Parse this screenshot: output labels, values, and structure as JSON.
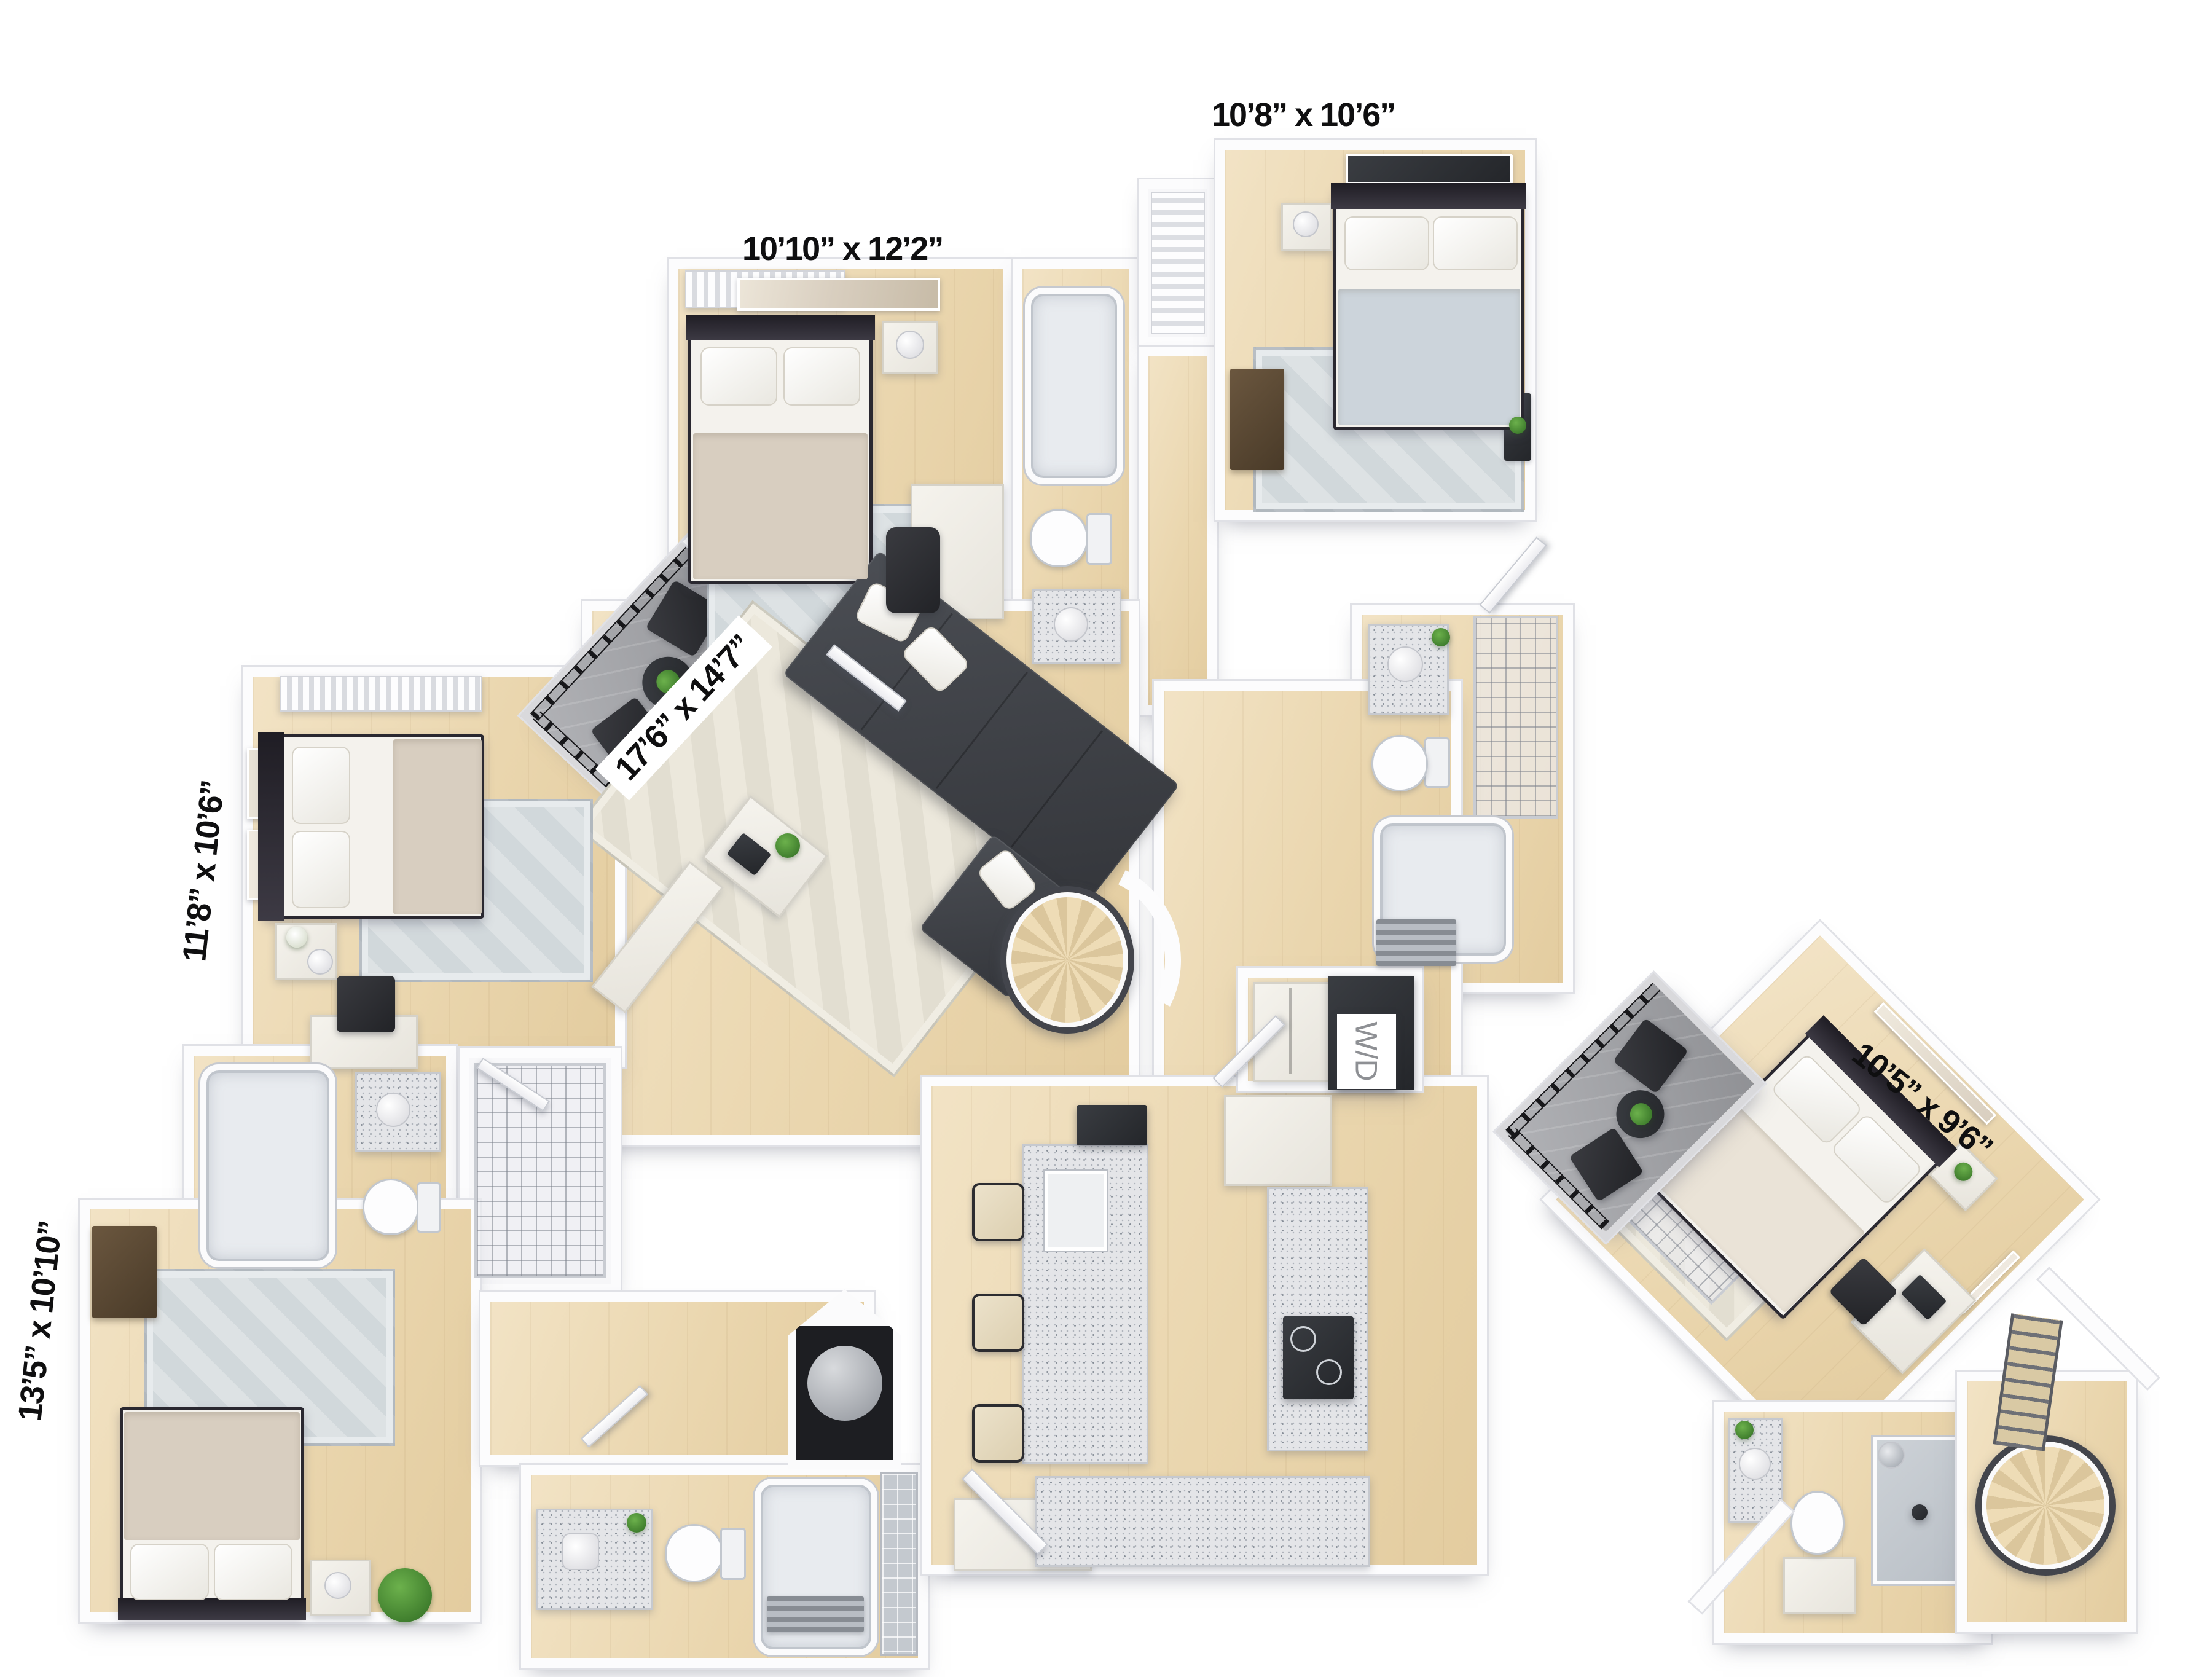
{
  "floorplan": {
    "rooms": {
      "bedroom_top_right": {
        "dimensions": "10’8” x 10’6”"
      },
      "bedroom_top_middle": {
        "dimensions": "10’10” x 12’2”"
      },
      "living_room": {
        "dimensions": "17’6” x 14’7”"
      },
      "bedroom_left": {
        "dimensions": "11’8” x 10’6”"
      },
      "bedroom_bottom_left": {
        "dimensions": "13’5” x 10’10”"
      },
      "bedroom_detached": {
        "dimensions": "10’5” x 9’6”"
      }
    },
    "laundry": {
      "label": "W/D"
    },
    "colors": {
      "walls": "#fcfcfd",
      "wall_outline": "#e0e1e6",
      "floor_wood": "#ead6ae",
      "balcony_floor": "#a7a8ac",
      "railing": "#17171a",
      "sofa": "#34363b",
      "rug_blue": "#d7dde0",
      "rug_cream": "#e9e5d8",
      "bedding_white": "#f4f2ed",
      "blanket_beige": "#d8cec0",
      "blanket_blue": "#ccd4db",
      "granite": "#e4e5e8",
      "stair_wood": "#eedcb6",
      "plant_green": "#2f6b22",
      "label_text": "#0f0f10",
      "wd_text": "#8e9094"
    }
  }
}
